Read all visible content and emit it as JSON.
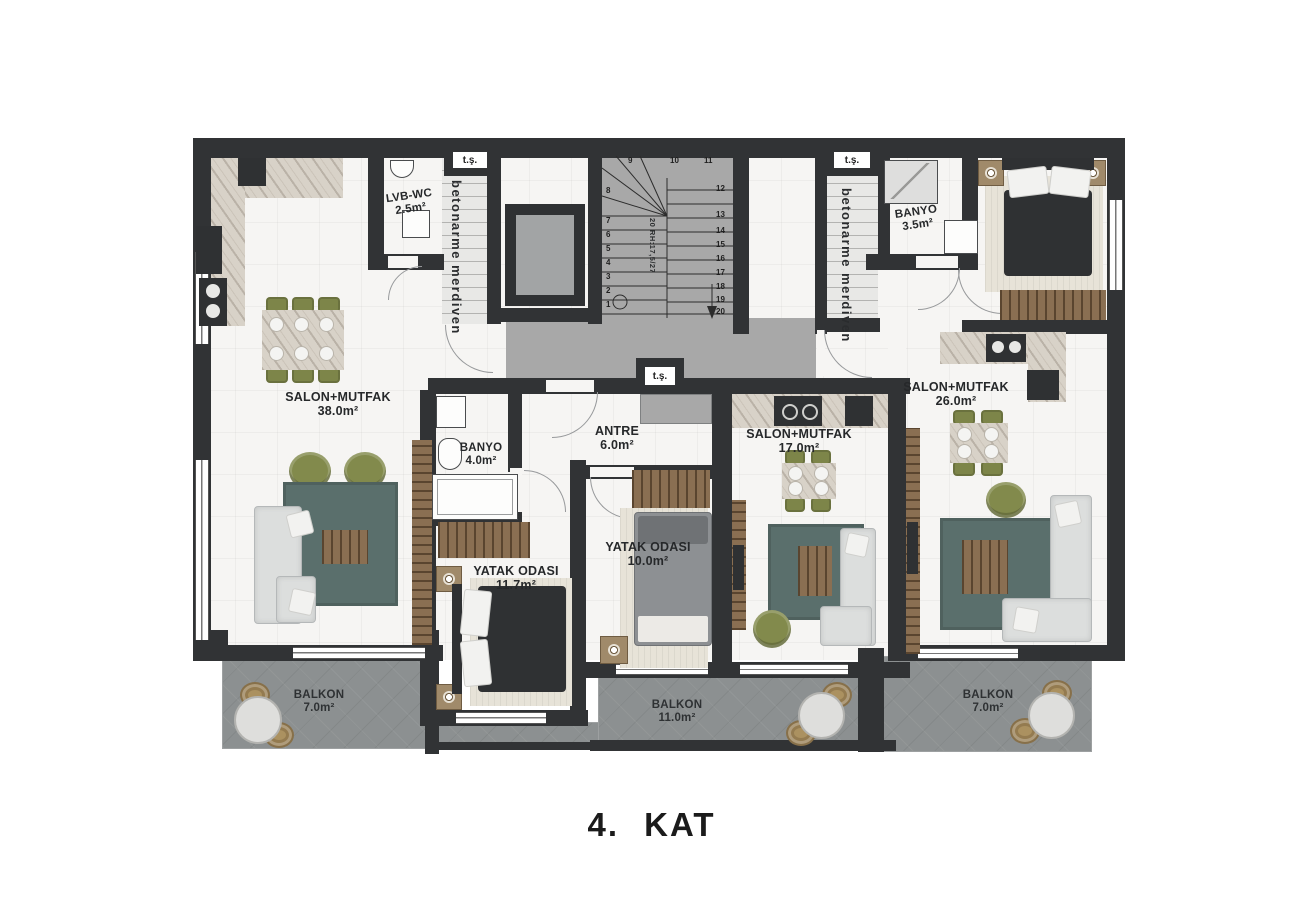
{
  "title": "4. KAT",
  "plan": {
    "rooms": {
      "salon38": {
        "name": "SALON+MUTFAK",
        "area": "38.0m²"
      },
      "lvb_wc": {
        "name": "LVB-WC",
        "area": "2.5m²"
      },
      "banyo4": {
        "name": "BANYO",
        "area": "4.0m²"
      },
      "antre": {
        "name": "ANTRE",
        "area": "6.0m²"
      },
      "salon17": {
        "name": "SALON+MUTFAK",
        "area": "17.0m²"
      },
      "salon26": {
        "name": "SALON+MUTFAK",
        "area": "26.0m²"
      },
      "banyo35": {
        "name": "BANYO",
        "area": "3.5m²"
      },
      "yatak117": {
        "name": "YATAK ODASI",
        "area": "11.7m²"
      },
      "yatak10": {
        "name": "YATAK ODASI",
        "area": "10.0m²"
      },
      "balkon_left": {
        "name": "BALKON",
        "area": "7.0m²"
      },
      "balkon_mid": {
        "name": "BALKON",
        "area": "11.0m²"
      },
      "balkon_right": {
        "name": "BALKON",
        "area": "7.0m²"
      }
    },
    "stairs": {
      "left_label": "betonarme merdiven",
      "right_label": "betonarme merdiven",
      "ts": "t.ş.",
      "riser_note": "20 RH:17,5/27",
      "step_numbers": [
        "1",
        "2",
        "3",
        "4",
        "5",
        "6",
        "7",
        "8",
        "9",
        "10",
        "11",
        "12",
        "13",
        "14",
        "15",
        "16",
        "17",
        "18",
        "19",
        "20"
      ]
    },
    "colors": {
      "wall": "#313335",
      "corridor": "#a8a8a8",
      "balcony": "#8c9091",
      "rug": "#5a6f6c",
      "chair": "#7d8549",
      "wood": "#8a6f52",
      "marble": "#d8d2c8"
    }
  }
}
